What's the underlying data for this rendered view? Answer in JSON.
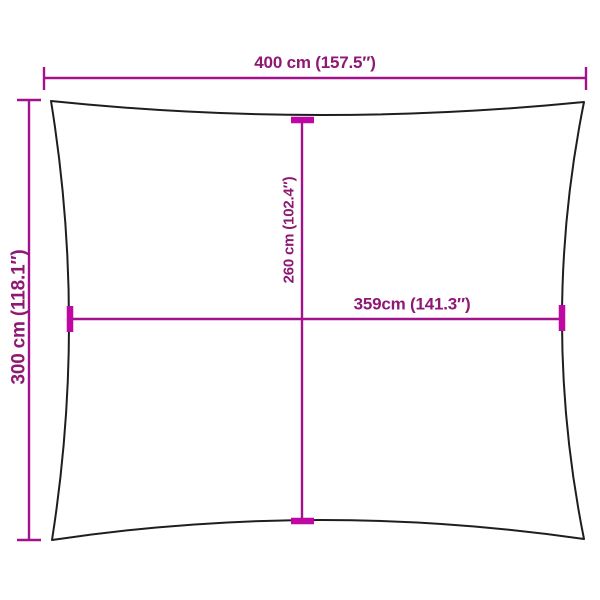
{
  "diagram": {
    "labels": {
      "top_width": "400 cm (157.5″)",
      "left_height": "300 cm (118.1″)",
      "inner_height": "260 cm (102.4″)",
      "inner_width": "359cm (141.3″)"
    },
    "colors": {
      "dimension_line": "#A1128C",
      "dimension_text": "#8E1874",
      "edge_tick": "#BF07A3",
      "outline": "#1E1E1E",
      "background": "#FFFFFF"
    }
  }
}
